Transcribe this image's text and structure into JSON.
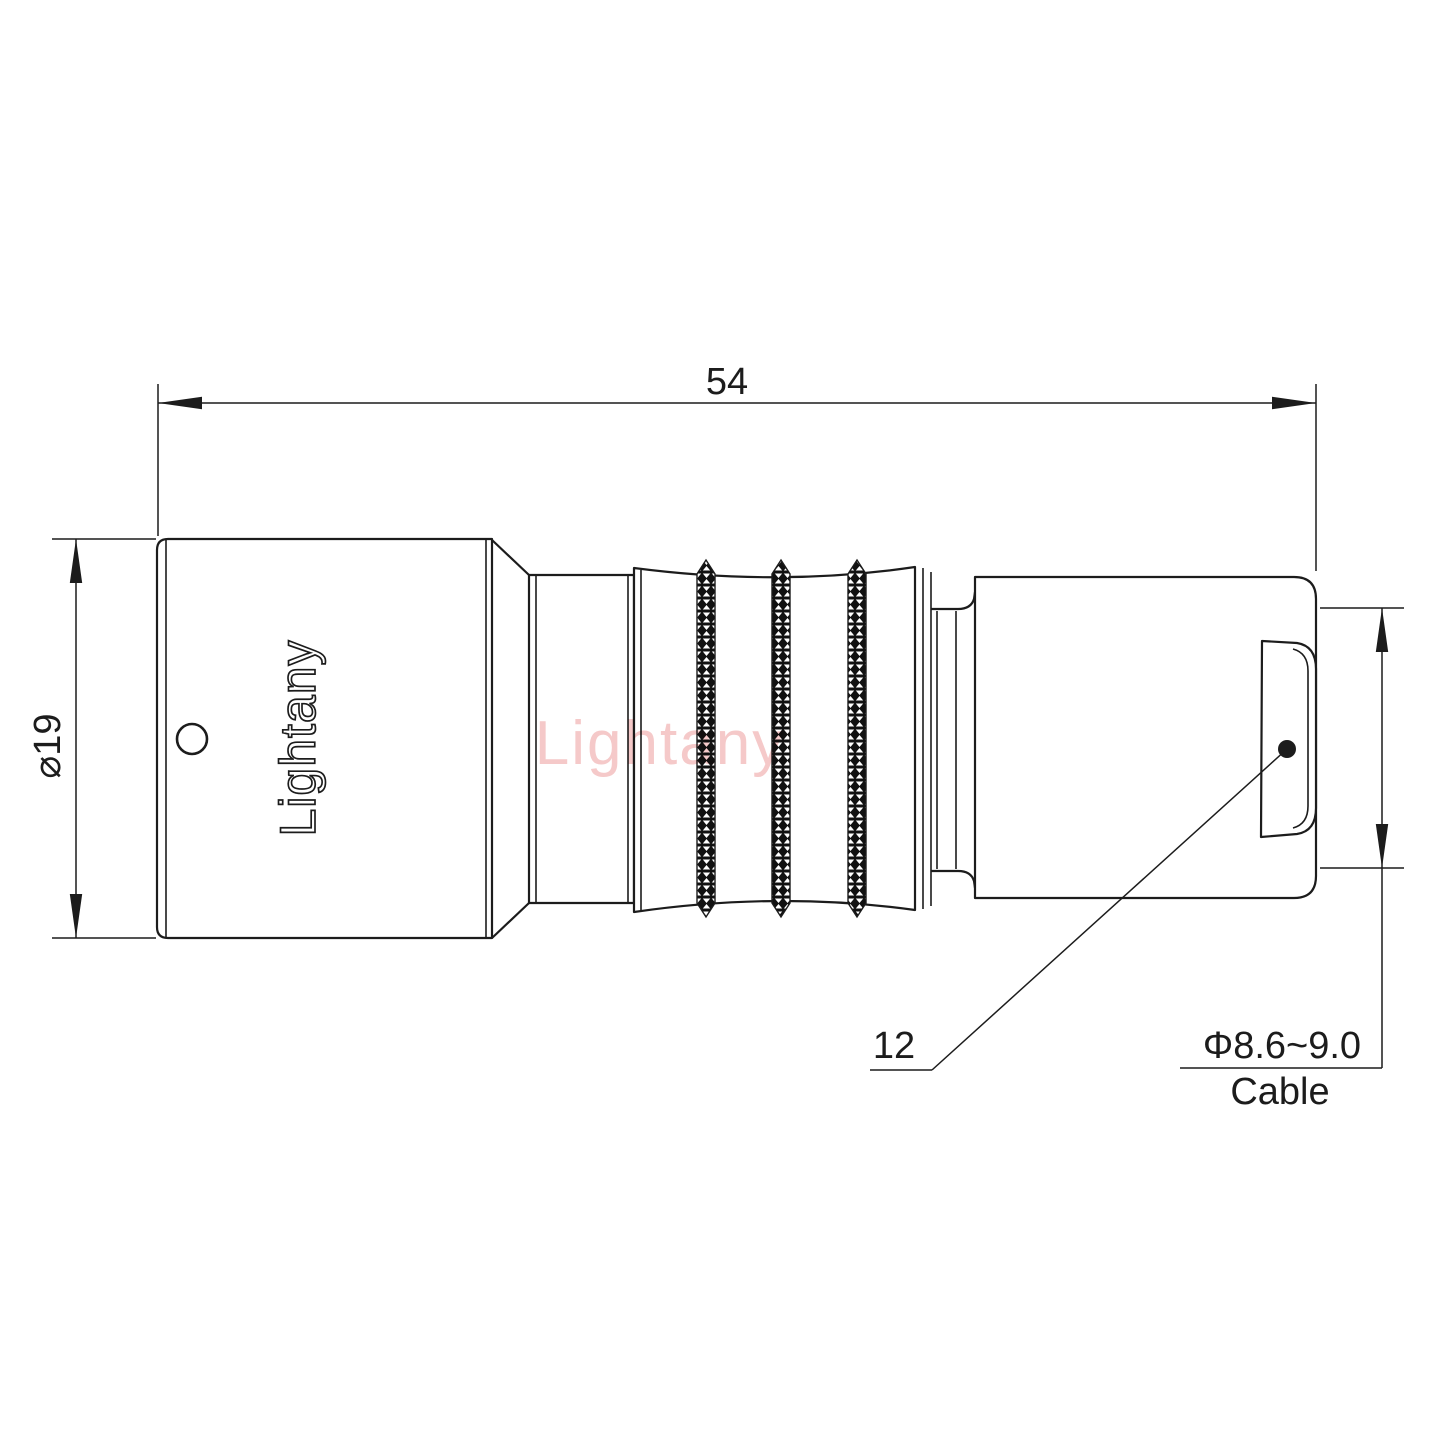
{
  "drawing": {
    "watermark_text": "Lightany",
    "engraving_text": "Lightany",
    "dimensions": {
      "overall_length": "54",
      "body_diameter": "⌀19",
      "rear_section": "12",
      "cable_diameter": "Φ8.6~9.0",
      "cable_word": "Cable"
    },
    "colors": {
      "line": "#1c1c1c",
      "watermark": "#f5c9c9",
      "knurl_fill": "#111111",
      "background": "#ffffff"
    }
  }
}
